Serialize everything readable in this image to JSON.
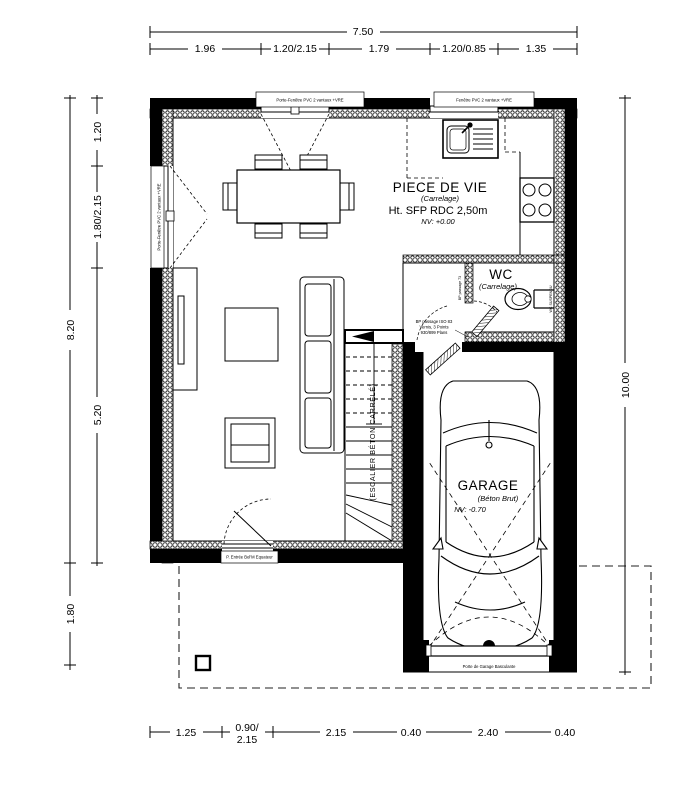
{
  "colors": {
    "ink": "#000000",
    "paper": "#ffffff"
  },
  "dims": {
    "top_total": "7.50",
    "top_segments": [
      "1.96",
      "1.20/2.15",
      "1.79",
      "1.20/0.85",
      "1.35"
    ],
    "left_inner": [
      "1.20",
      "1.80/2.15",
      "5.20"
    ],
    "left_outer": [
      "8.20",
      "1.80"
    ],
    "right_total": "10.00",
    "bottom_segments": [
      "1.25",
      "0.90/",
      "2.15",
      "2.15",
      "0.40",
      "2.40",
      "0.40"
    ]
  },
  "rooms": {
    "living": {
      "name": "PIECE DE VIE",
      "finish": "(Carrelage)",
      "height": "Ht. SFP RDC 2,50m",
      "level": "NV: +0.00"
    },
    "wc": {
      "name": "WC",
      "finish": "(Carrelage)",
      "fixture": "WC SUSPENDU"
    },
    "garage": {
      "name": "GARAGE",
      "finish": "(Béton Brut)",
      "level": "NV: -0.70"
    },
    "stair": {
      "label": "(ESCALIER BÉTON CARRELÉ)"
    }
  },
  "openings": {
    "top_french_door": "Porte-Fenêtre PVC 2 vantaux +VRE",
    "kitchen_window": "Fenêtre PVC 2 vantaux +VRE",
    "left_french_door": "Porte-Fenêtre PVC 2 vantaux +VRE",
    "entry_door": "P. Entrée Bel'M Equateur",
    "garage_door": "Porte de Garage Basculante",
    "wc_door": "BP passage 73",
    "passage_door_lines": [
      "BP passage ISO 83",
      "Vernis, 3 Points",
      "930/899 Plans"
    ]
  }
}
